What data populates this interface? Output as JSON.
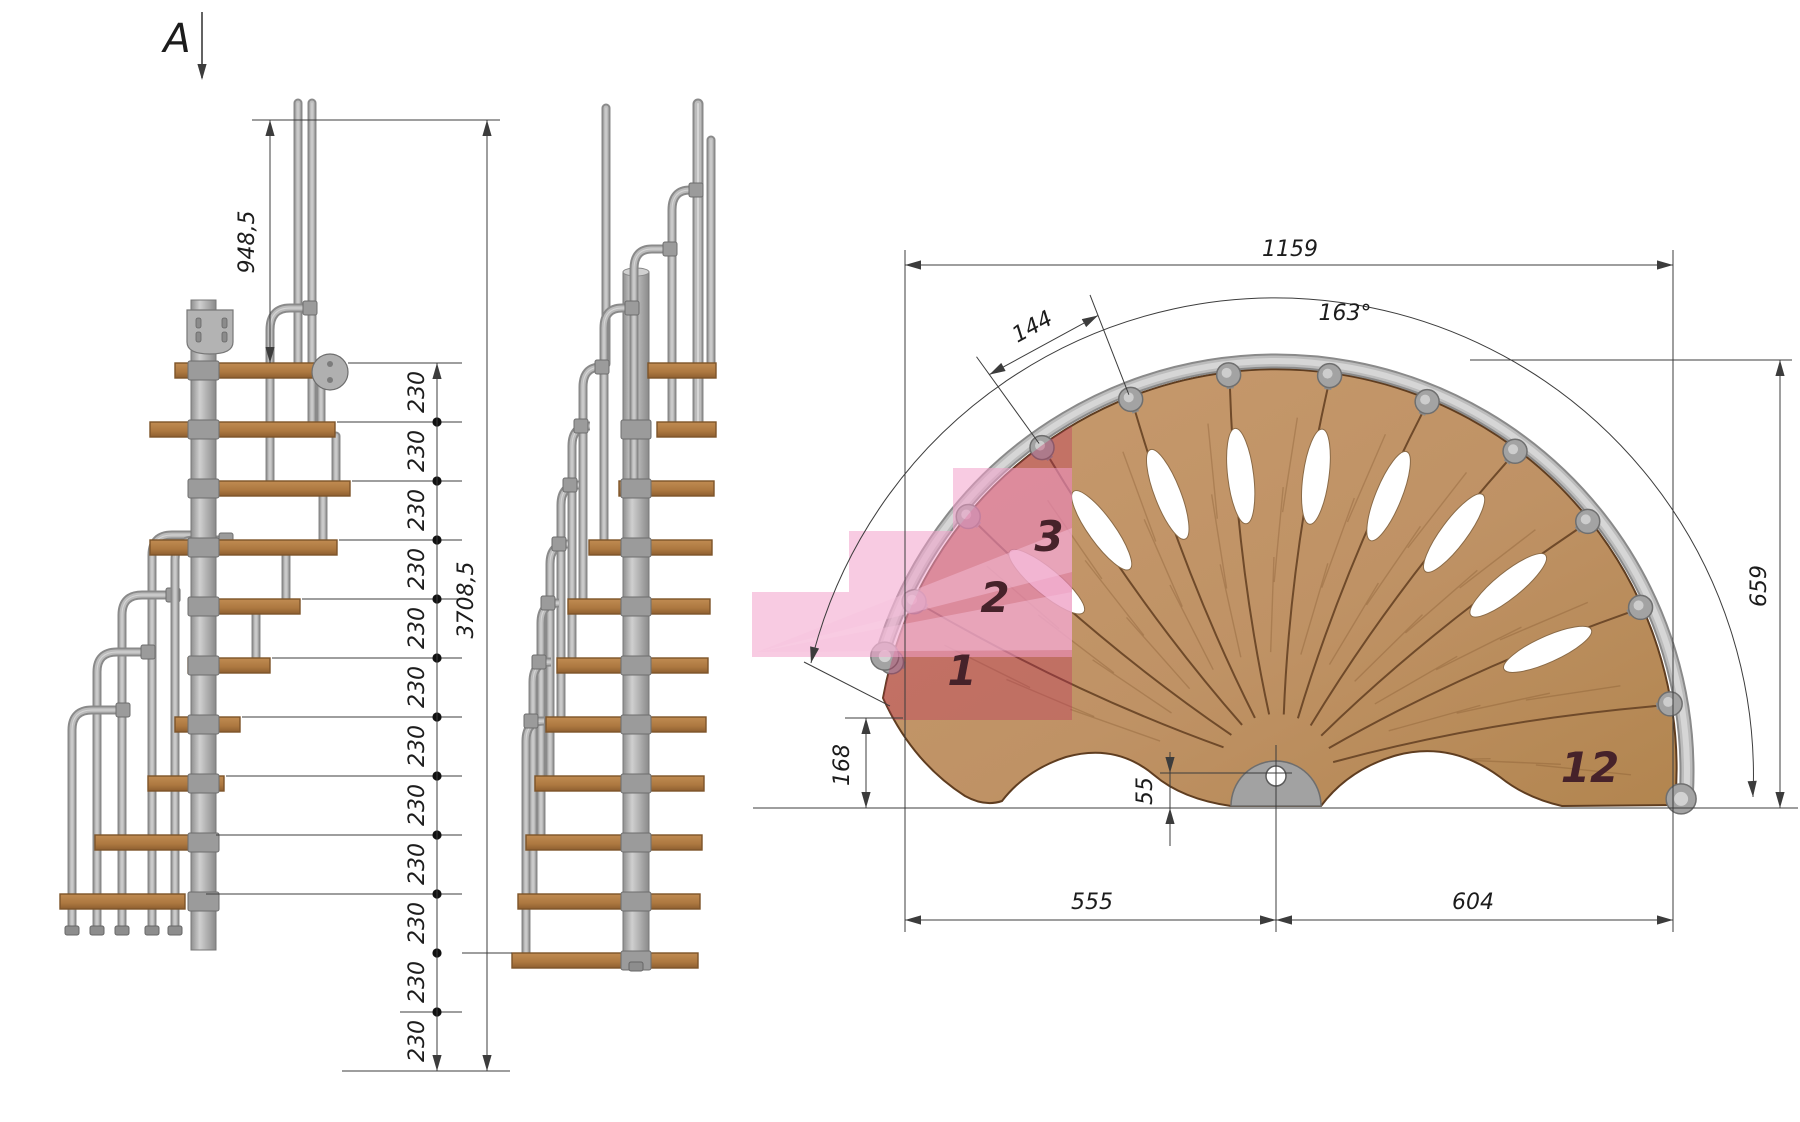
{
  "drawing_title": "modular spiral staircase technical drawing",
  "view_label": "A",
  "side_elevation": {
    "handrail_height": "948,5",
    "riser_height": "230",
    "riser_count": 12,
    "total_height": "3708,5"
  },
  "plan_view": {
    "overall_width": "1159",
    "sweep_angle": "163°",
    "step_outer_width": "144",
    "height_extent": "659",
    "step1_offset": "168",
    "pole_offset": "55",
    "left_span": "555",
    "right_span": "604",
    "step_numbers": {
      "first": "1",
      "second": "2",
      "third": "3",
      "last": "12"
    }
  },
  "colors": {
    "wood": "#c0956a",
    "wood_edge": "#5f3d20",
    "wood_seam": "#6f4a2a",
    "tread_fill": "#b07a44",
    "tread_edge": "#7d5429",
    "metal": "#bcbcbc",
    "metal_light": "#d6d6d6",
    "metal_dark": "#8a8a8a",
    "pole_fill": "#a2a2a2",
    "pink": "#f2a0cb",
    "pink_light": "#f6c4dd",
    "crimson": "#c22d5e",
    "maroon": "#46222a",
    "dim_line": "#3c3c3c",
    "dim_text": "#1c1c1c"
  }
}
